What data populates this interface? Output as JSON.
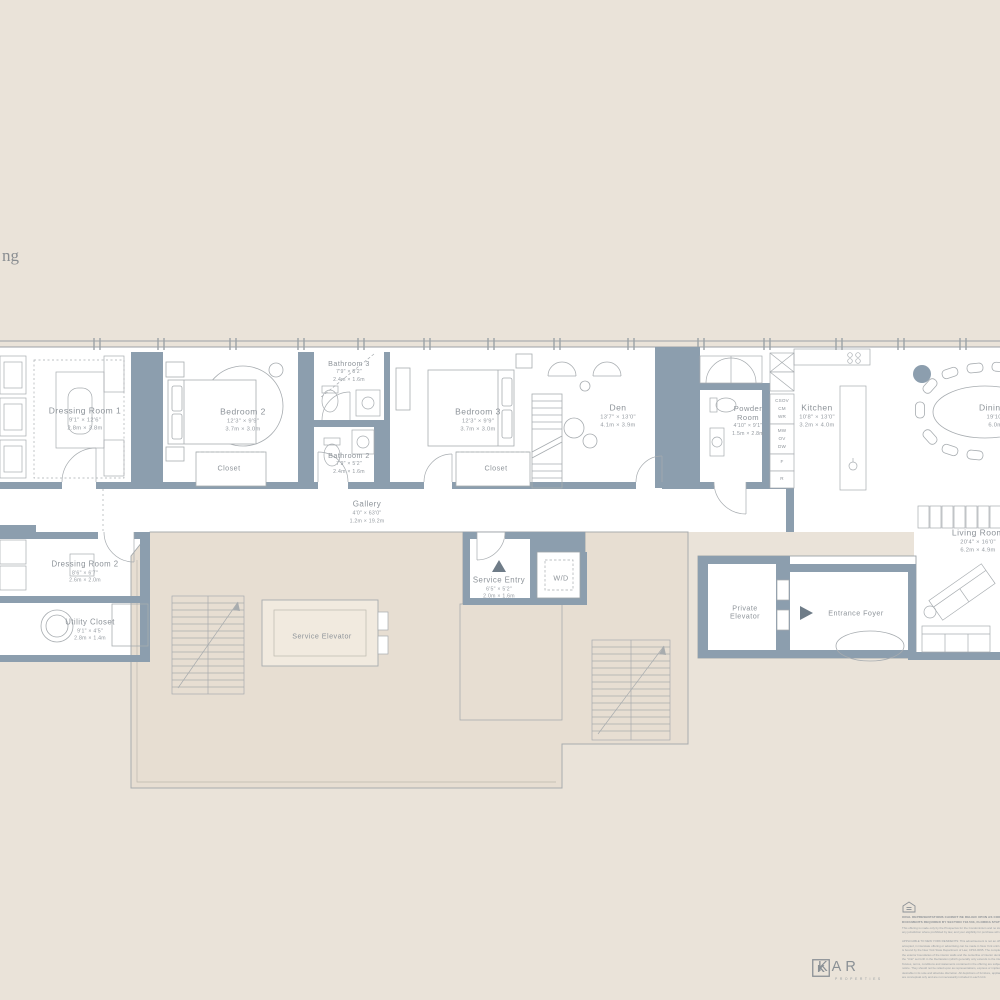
{
  "fragment_text": "ng",
  "rooms": [
    {
      "id": "dressing-room-1",
      "name": "Dressing Room 1",
      "feet": "9'1\" × 12'6\"",
      "meters": "2.8m × 3.8m"
    },
    {
      "id": "bedroom-2",
      "name": "Bedroom 2",
      "feet": "12'3\" × 9'9\"",
      "meters": "3.7m × 3.0m"
    },
    {
      "id": "bathroom-3",
      "name": "Bathroom 3",
      "feet": "7'9\" × 5'2\"",
      "meters": "2.4m × 1.6m"
    },
    {
      "id": "bathroom-2",
      "name": "Bathroom 2",
      "feet": "7'9\" × 5'2\"",
      "meters": "2.4m × 1.6m"
    },
    {
      "id": "bedroom-3",
      "name": "Bedroom 3",
      "feet": "12'3\" × 9'9\"",
      "meters": "3.7m × 3.0m"
    },
    {
      "id": "den",
      "name": "Den",
      "feet": "13'7\" × 13'0\"",
      "meters": "4.1m × 3.9m"
    },
    {
      "id": "powder-room",
      "name": "Powder Room",
      "feet": "4'10\" × 9'1\"",
      "meters": "1.5m × 2.8m"
    },
    {
      "id": "kitchen",
      "name": "Kitchen",
      "feet": "10'8\" × 13'0\"",
      "meters": "3.2m × 4.0m"
    },
    {
      "id": "dining-room",
      "name": "Dining Room",
      "feet": "19'10\" × 13'2\"",
      "meters": "6.0m × 4.0m"
    },
    {
      "id": "gallery",
      "name": "Gallery",
      "feet": "4'0\" × 63'0\"",
      "meters": "1.2m × 19.2m"
    },
    {
      "id": "dressing-room-2",
      "name": "Dressing Room 2",
      "feet": "8'6\" × 6'7\"",
      "meters": "2.6m × 2.0m"
    },
    {
      "id": "utility-closet",
      "name": "Utility Closet",
      "feet": "9'1\" × 4'5\"",
      "meters": "2.8m × 1.4m"
    },
    {
      "id": "service-entry",
      "name": "Service Entry",
      "feet": "6'5\" × 5'2\"",
      "meters": "2.0m × 1.6m"
    },
    {
      "id": "living-room",
      "name": "Living Room",
      "feet": "20'4\" × 16'0\"",
      "meters": "6.2m × 4.9m"
    }
  ],
  "labels": {
    "closet": "Closet",
    "wd": "W/D",
    "service_elevator": "Service Elevator",
    "private_elevator": "Private Elevator",
    "entrance_foyer": "Entrance Foyer"
  },
  "appliances": {
    "stack_top": [
      "CSOV",
      "CM",
      "WR"
    ],
    "stack_mid": [
      "MW",
      "OV",
      "DW"
    ],
    "freezer": "F",
    "refrigerator": "R"
  },
  "footer": {
    "legal_bold": [
      "ORAL REPRESENTATIONS CANNOT BE RELIED UPON AS CORRECTLY STATING THE REPRESENTATIONS OF THE DEVELOPER. FOR CORRECT REPRESENTATIONS, MAKE REFERENCE TO THE",
      "DOCUMENTS REQUIRED BY SECTION 718.503, FLORIDA STATUTES, TO BE FURNISHED BY A DEVELOPER TO A BUYER OR LESSEE."
    ],
    "legal_intro": [
      "This offering is made only by the Prospectus for the Condominium and no statement should be relied upon if not made in the Prospectus. This is not an offer to sell, or solicitation of offers to buy, the condominium units in",
      "any jurisdiction where prohibited by law, and your eligibility for purchase will depend upon your state of residency."
    ],
    "legal_ny": [
      "APPLICABLE TO NEW YORK RESIDENTS: This advertisement is not an offering. It is a solicitation of interest in the advertised property. No offering of the advertised units can be made and no deposits can be",
      "accepted, in interstate offering or advertising can be made in New York until an offering plan is filed with the New York State Department of Law. This advertisement is made pursuant to Cooperative Policy",
      "is bound by the New York State Department of Law, CP16-0095. The complete offering terms are in an offering plan available from Sponsor. Measurements are measured from and to",
      "the exterior boundaries of the interior walls and the centerline of interior demising walls, which differs from the measurement of the square footage of",
      "the \"Unit\" set forth in the Declaration (which generally only extends to the interior unfinished surfaces of the perimeter walls, floors and ceilings). All",
      "fixtures, terms, conditions and statements contained in the offering are subject to change in the sole discretion of Sponsor without",
      "notice. They should not be relied upon as representations, express or implied. Sponsor reserves the right to make changes it deems",
      "desirable in its sole and absolute discretion. All depictions of furniture, appliances, counters, soffits, floor coverings and other matters of detail",
      "are conceptual only and are not necessarily included in each Unit."
    ],
    "brand_name": "KAR",
    "brand_sub": "PROPERTIES"
  },
  "colors": {
    "background": "#EAE3D9",
    "wall": "#8C9EAE",
    "line": "#9CA2A7",
    "core_fill": "#E7DED2",
    "label_text": "#8D9399",
    "marker": "#6F7C88"
  }
}
